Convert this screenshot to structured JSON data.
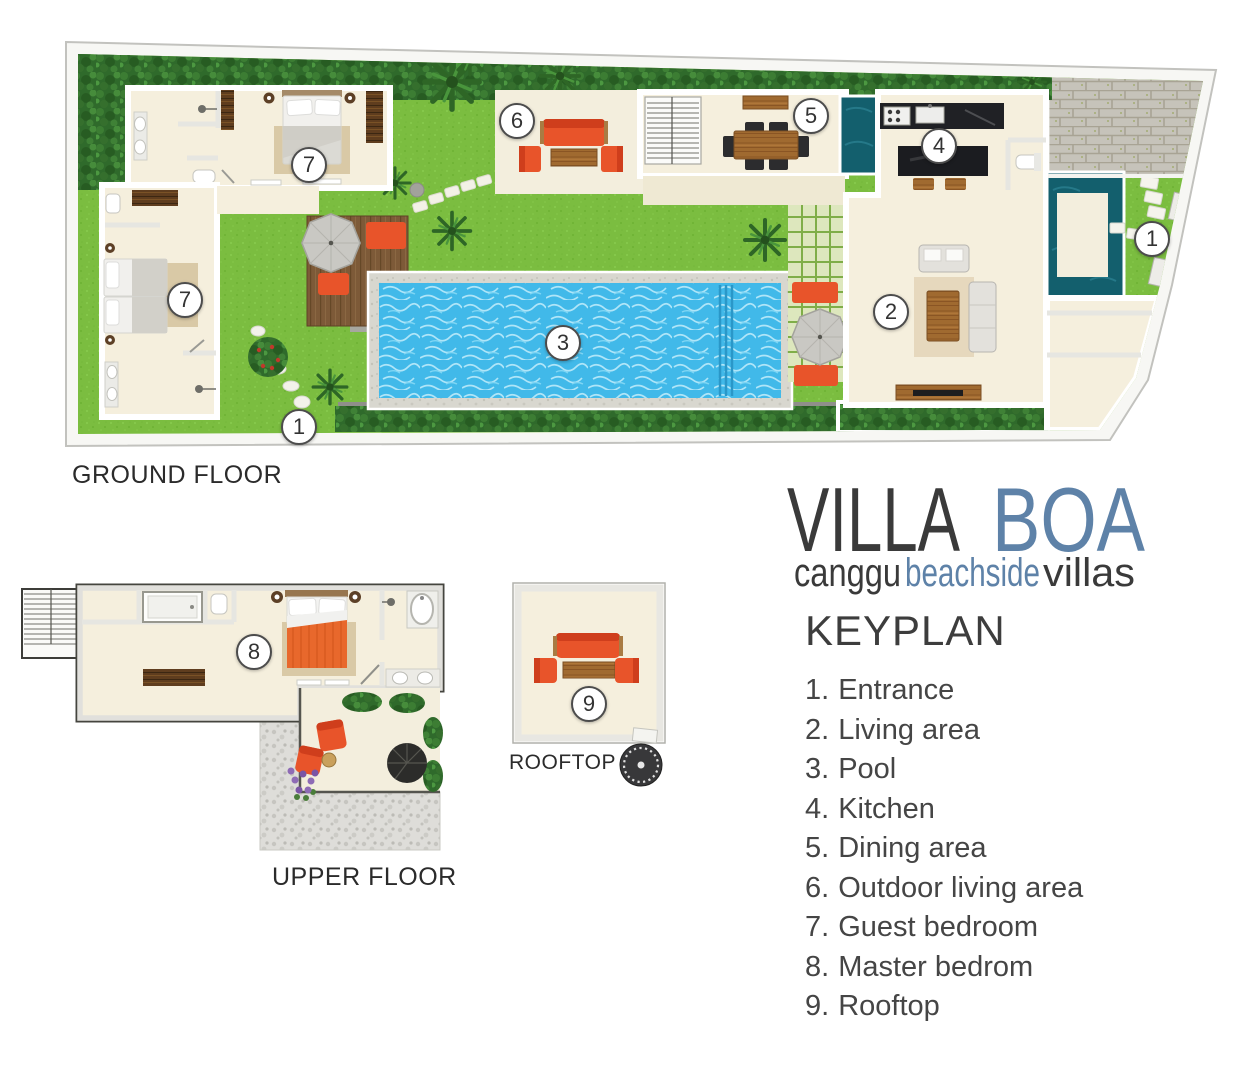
{
  "logo": {
    "title_word1": "VILLA",
    "title_word2": "BOA",
    "subtitle_word1": "canggu",
    "subtitle_word2": "beachside",
    "subtitle_word3": "villas"
  },
  "floors": {
    "ground": {
      "label": "GROUND FLOOR"
    },
    "upper": {
      "label": "UPPER FLOOR"
    },
    "rooftop": {
      "label": "ROOFTOP"
    }
  },
  "keyplan": {
    "heading": "KEYPLAN",
    "items": [
      {
        "num": "1.",
        "label": "Entrance"
      },
      {
        "num": "2.",
        "label": "Living area"
      },
      {
        "num": "3.",
        "label": "Pool"
      },
      {
        "num": "4.",
        "label": "Kitchen"
      },
      {
        "num": "5.",
        "label": "Dining area"
      },
      {
        "num": "6.",
        "label": "Outdoor living area"
      },
      {
        "num": "7.",
        "label": "Guest bedroom"
      },
      {
        "num": "8.",
        "label": "Master bedrom"
      },
      {
        "num": "9.",
        "label": "Rooftop"
      }
    ]
  },
  "markers": {
    "entrance": "1",
    "living_area": "2",
    "pool": "3",
    "kitchen": "4",
    "dining_area": "5",
    "outdoor_living_area": "6",
    "guest_bedroom": "7",
    "master_bedroom": "8",
    "rooftop": "9"
  },
  "colors": {
    "accent_orange": "#e8542a",
    "logo_blue": "#5e82a8",
    "grass_green": "#7bbd40",
    "hedge_green": "#2f6a2b",
    "pool_blue": "#41b9e9",
    "pond_teal": "#135f6d",
    "floor_cream": "#f5efdd",
    "wood_brown": "#a06a30",
    "text_dark": "#3a3a3a"
  }
}
